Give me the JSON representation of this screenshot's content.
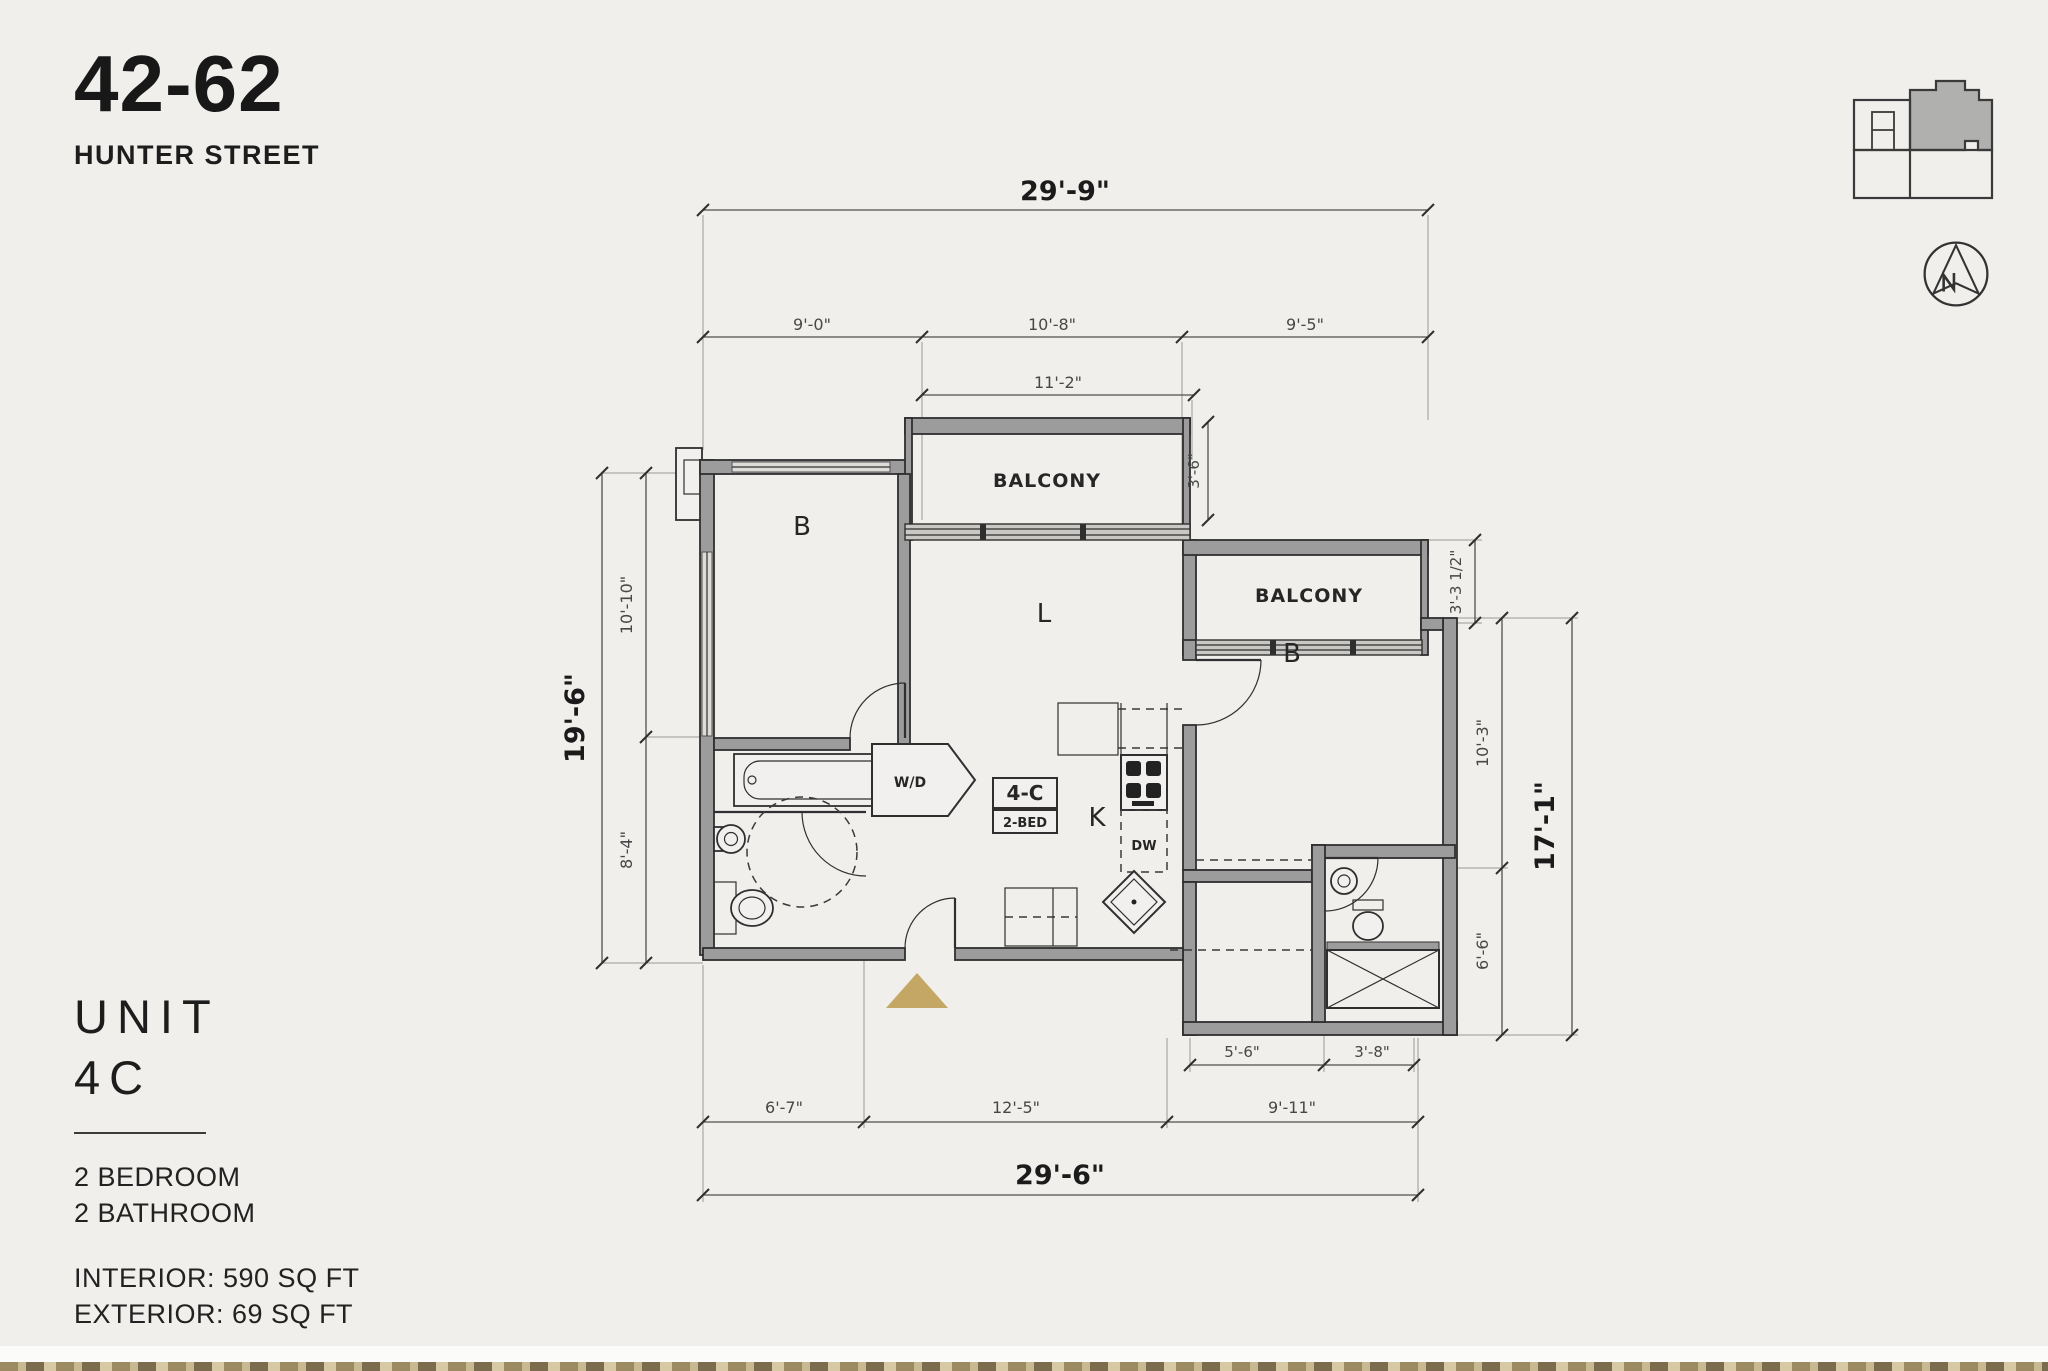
{
  "page": {
    "background": "#f0efec",
    "accent_gold": "#c5a765"
  },
  "header": {
    "number": "42-62",
    "street": "HUNTER STREET"
  },
  "unit": {
    "title_line1": "UNIT",
    "title_line2": "4C",
    "bedrooms": "2 BEDROOM",
    "bathrooms": "2 BATHROOM",
    "interior": "INTERIOR: 590 SQ FT",
    "exterior": "EXTERIOR: 69 SQ FT"
  },
  "floor_plan": {
    "dims": {
      "top_overall": "29'-9\"",
      "top_segments": [
        "9'-0\"",
        "10'-8\"",
        "9'-5\""
      ],
      "balcony1_width": "11'-2\"",
      "balcony1_depth": "3'-6\"",
      "balcony2_depth": "3'-3 1/2\"",
      "left_overall": "19'-6\"",
      "left_segments": [
        "10'-10\"",
        "8'-4\""
      ],
      "right_overall": "17'-1\"",
      "right_segments": [
        "10'-3\"",
        "6'-6\""
      ],
      "bottom_overall": "29'-6\"",
      "bottom_segments": [
        "6'-7\"",
        "12'-5\"",
        "9'-11\""
      ],
      "bottom_right_segments": [
        "5'-6\"",
        "3'-8\""
      ]
    },
    "rooms": {
      "bedroom1": "B",
      "living": "L",
      "bedroom2": "B",
      "kitchen": "K",
      "balcony1": "BALCONY",
      "balcony2": "BALCONY",
      "washer_dryer": "W/D",
      "dishwasher": "DW",
      "unit_tag": "4-C",
      "unit_tag_sub": "2-BED"
    }
  },
  "compass": {
    "direction": "N"
  }
}
